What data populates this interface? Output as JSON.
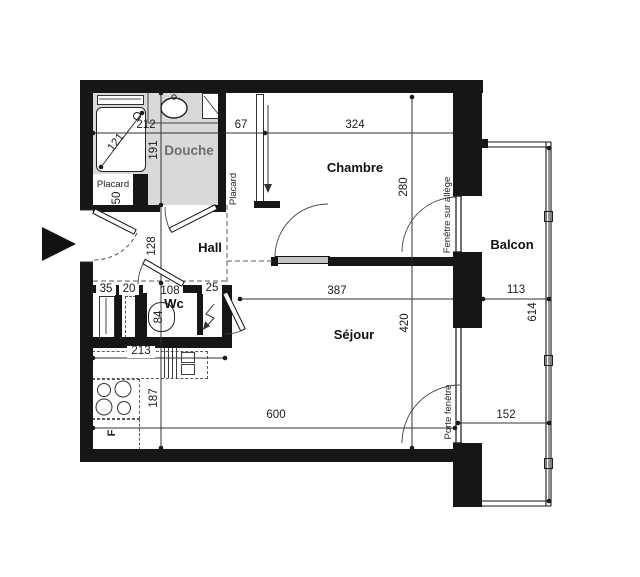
{
  "plan": {
    "rooms": {
      "douche": "Douche",
      "chambre": "Chambre",
      "hall": "Hall",
      "wc": "Wc",
      "sejour": "Séjour",
      "balcon": "Balcon",
      "placard_entree": "Placard",
      "placard_chambre": "Placard",
      "fridge": "F"
    },
    "openings": {
      "fenetre_chambre": "Fenêtre sur allège",
      "porte_fenetre_sejour": "Porte fenêtre"
    },
    "dimensions_cm": {
      "douche_width": "212",
      "douche_height": "191",
      "shower_diagonal": "121",
      "placard_entree": "50",
      "placard_chambre": "67",
      "chambre_width": "324",
      "chambre_height": "280",
      "hall": "128",
      "wc_depth": "108",
      "wc_width": "84",
      "gaine_left": "35",
      "gaine_mid": "20",
      "gaine_right": "25",
      "kitchen_width": "213",
      "kitchen_depth": "187",
      "sejour_width": "387",
      "sejour_depth": "420",
      "sejour_total_width": "600",
      "balcon_width_top": "113",
      "balcon_length": "614",
      "balcon_width_bottom": "152"
    }
  }
}
